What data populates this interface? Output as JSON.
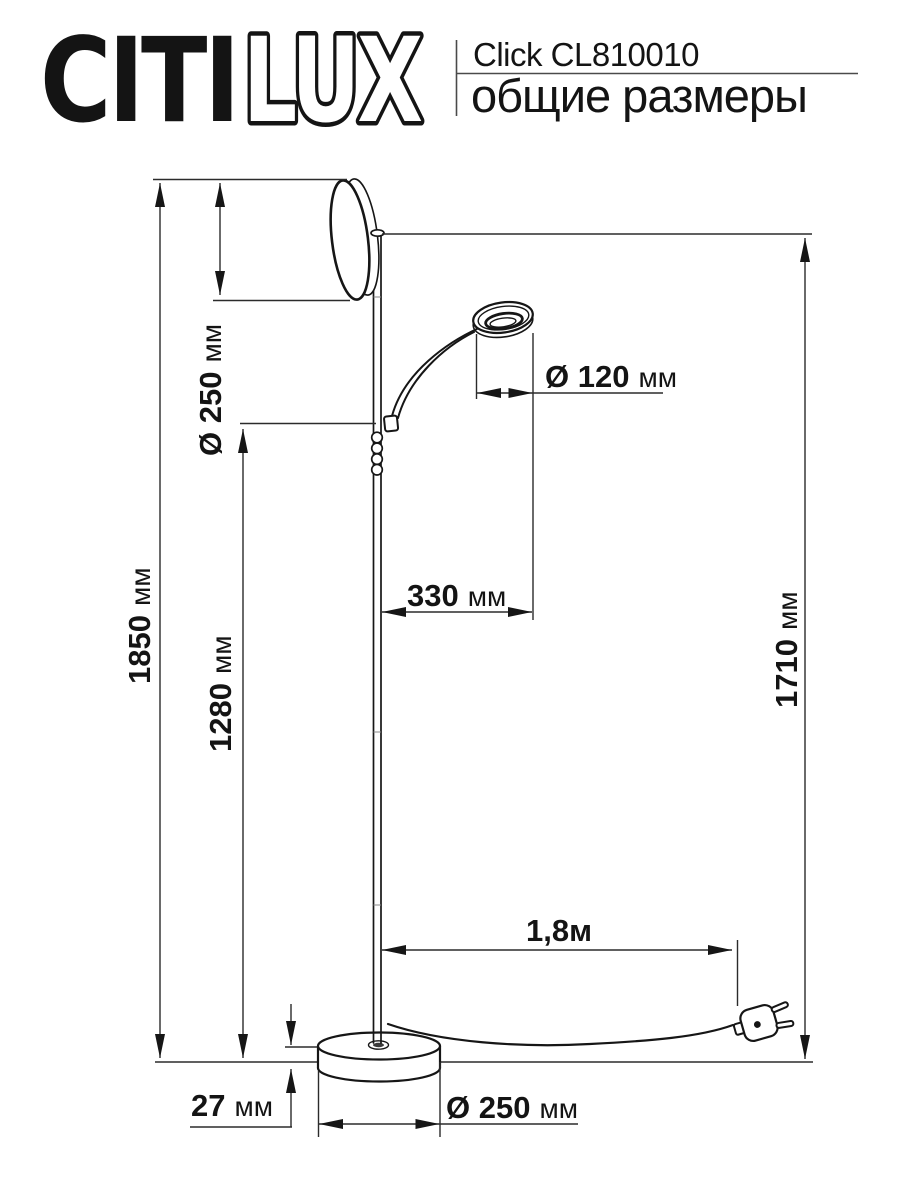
{
  "header": {
    "logo": {
      "solid": "CITI",
      "outline": "LUX"
    },
    "product_name": "Click CL810010",
    "subtitle": "общие размеры"
  },
  "colors": {
    "ink": "#141414",
    "background": "#ffffff",
    "rule": "#4a4a4a"
  },
  "dims": {
    "unit_mm": "мм",
    "shade_diameter": {
      "num": "Ø 250"
    },
    "reading_diameter": {
      "num": "Ø 120"
    },
    "arm_length": {
      "num": "330"
    },
    "total_height": {
      "num": "1850"
    },
    "lower_height": {
      "num": "1280"
    },
    "plug_height": {
      "num": "1710"
    },
    "cable_length": {
      "num": "1,8м"
    },
    "base_height": {
      "num": "27"
    },
    "base_diameter": {
      "num": "Ø 250"
    }
  }
}
